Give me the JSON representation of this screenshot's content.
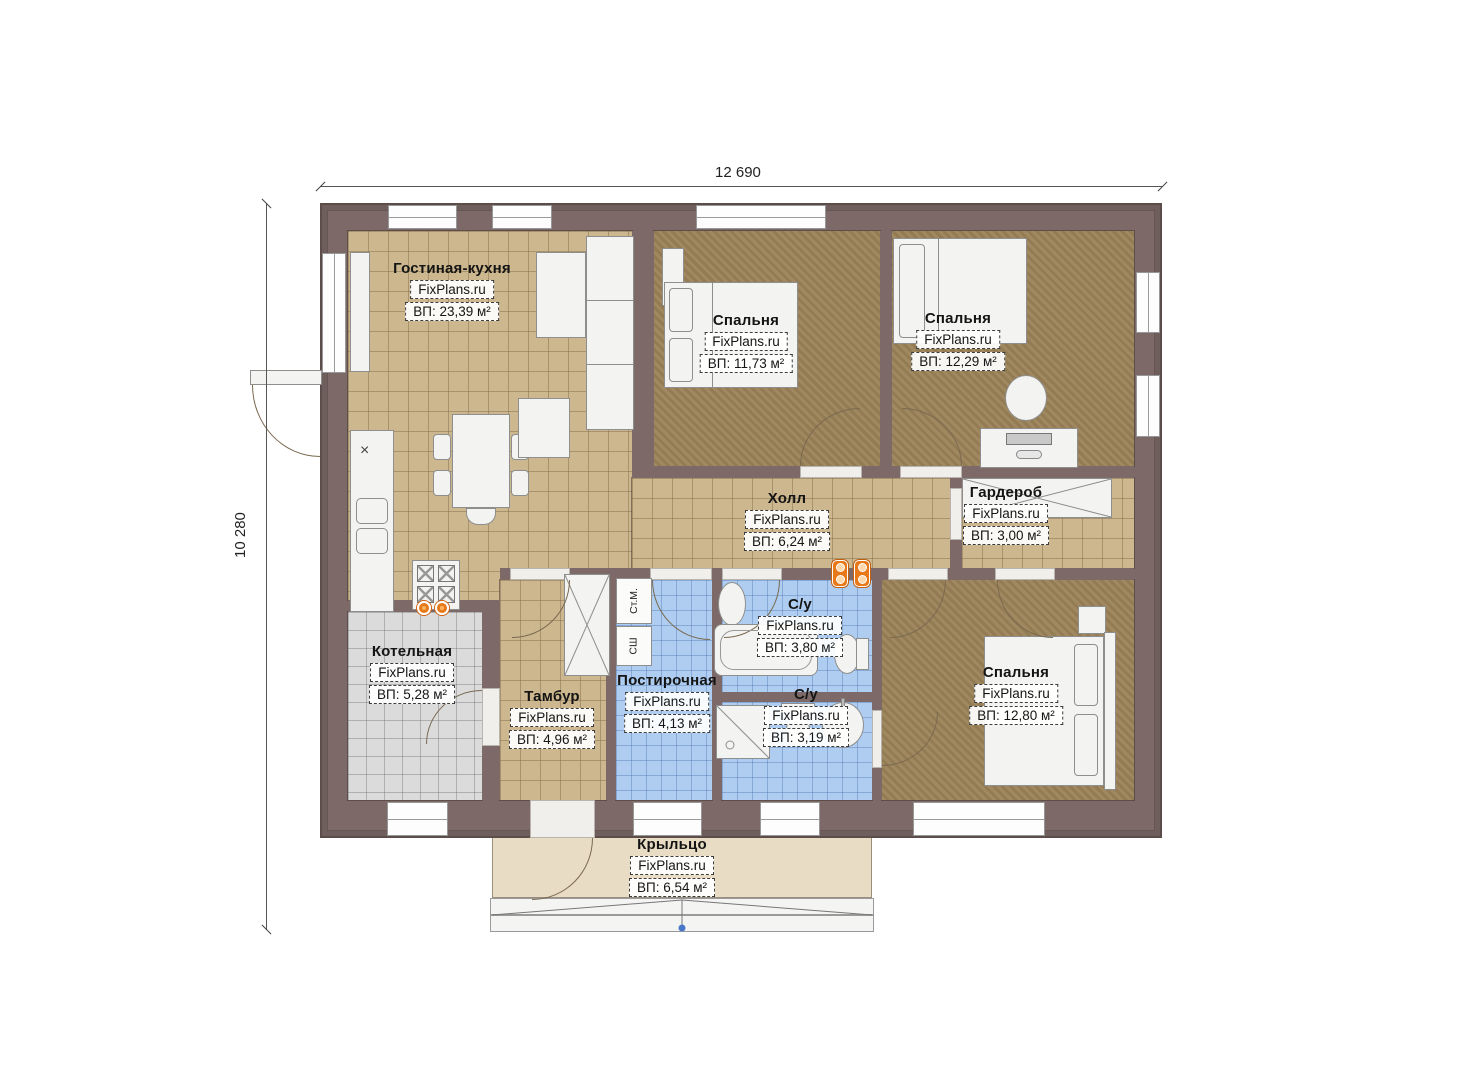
{
  "watermark": "FixPlans.ru",
  "dimensions": {
    "width_label": "12 690",
    "height_label": "10 280"
  },
  "rooms": {
    "living": {
      "name": "Гостиная-кухня",
      "area": "ВП: 23,39 м²"
    },
    "bedroom1": {
      "name": "Спальня",
      "area": "ВП: 11,73 м²"
    },
    "bedroom2": {
      "name": "Спальня",
      "area": "ВП: 12,29 м²"
    },
    "hall": {
      "name": "Холл",
      "area": "ВП: 6,24 м²"
    },
    "wardrobe": {
      "name": "Гардероб",
      "area": "ВП: 3,00 м²"
    },
    "boiler": {
      "name": "Котельная",
      "area": "ВП: 5,28 м²"
    },
    "tambour": {
      "name": "Тамбур",
      "area": "ВП: 4,96 м²"
    },
    "laundry": {
      "name": "Постирочная",
      "area": "ВП: 4,13 м²"
    },
    "bath1": {
      "name": "С/у",
      "area": "ВП: 3,80 м²"
    },
    "bath2": {
      "name": "С/у",
      "area": "ВП: 3,19 м²"
    },
    "bedroom3": {
      "name": "Спальня",
      "area": "ВП: 12,80 м²"
    },
    "porch": {
      "name": "Крыльцо",
      "area": "ВП: 6,54 м²"
    }
  },
  "appliances": {
    "washing_machine": "Ст.М.",
    "drying_cabinet": "СШ"
  },
  "symbols": {
    "hob_mark": "×"
  },
  "colors": {
    "wall": "#7d6a68",
    "floor_tan": "#cdb78e",
    "floor_brown": "#9b8257",
    "floor_blue": "#aecdf0",
    "floor_gray": "#dbdbdb",
    "porch": "#e9dcc5",
    "accent_orange": "#e87818",
    "entry_dot_blue": "#4a78c8"
  }
}
